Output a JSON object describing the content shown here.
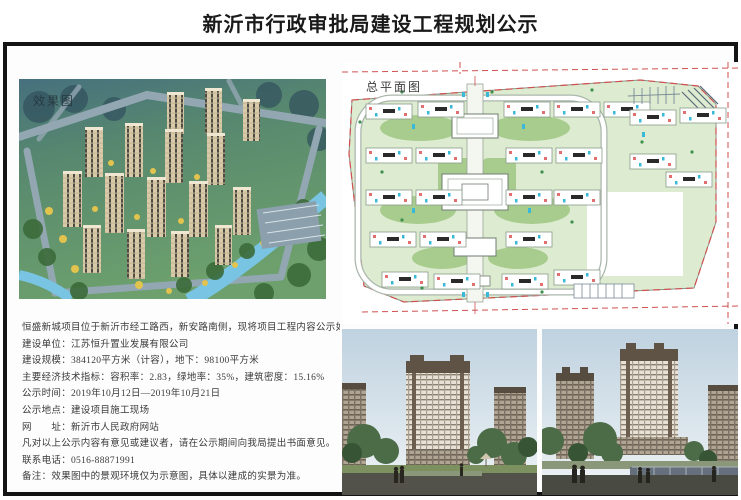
{
  "page": {
    "title": "新沂市行政审批局建设工程规划公示"
  },
  "images": {
    "aerial_label": "效果图",
    "siteplan_label": "总平面图"
  },
  "notice": {
    "lines": [
      "恒盛新城项目位于新沂市经工路西，新安路南侧，现将项目工程内容公示如下：",
      "建设单位：江苏恒升置业发展有限公司",
      "建设规模：384120平方米（计容），地下：98100平方米",
      "主要经济技术指标：容积率：2.83，绿地率：35%，建筑密度：15.16%",
      "公示时间：2019年10月12日—2019年10月21日",
      "公示地点：建设项目施工现场",
      "网　　址：新沂市人民政府网站",
      "凡对以上公示内容有意见或建议者，请在公示期间向我局提出书面意见。",
      "联系电话：0516-88871991",
      "备注：效果图中的景观环境仅为示意图，具体以建成的实景为准。"
    ]
  },
  "colors": {
    "frame": "#141414",
    "plan_green_light": "#ddecd0",
    "plan_green_dark": "#a8cc8e",
    "plan_boundary_red": "#d05050",
    "aerial_building_tan": "#d9cbaa",
    "river_blue": "#79c4e2",
    "photo_sky": "#c3d4e0"
  }
}
